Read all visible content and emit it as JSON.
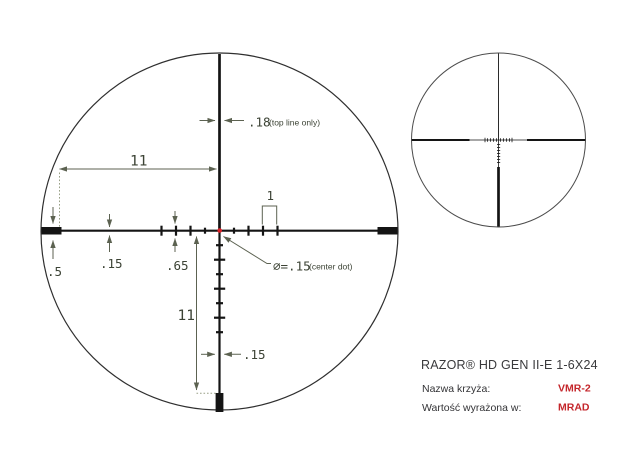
{
  "colors": {
    "ink": "#141414",
    "circle_outline": "#2f2f2f",
    "dimension_lines": "#5c6251",
    "dimension_text": "#3c4335",
    "center_dot_red": "#dd1f26",
    "value_red": "#c4262b",
    "title_text": "#3a3a3c"
  },
  "reticle": {
    "dims": {
      "top_line_width": ".18",
      "top_line_note": "(top line only)",
      "upper_offset": "11",
      "post_height": ".5",
      "line_width": ".15",
      "tick_height": ".65",
      "mil_spacing": "1",
      "center_dot_diameter": "∅=.15",
      "center_dot_note": "(center dot)",
      "lower_offset": "11",
      "lower_line_width": ".15"
    }
  },
  "info": {
    "product_title": "RAZOR® HD GEN II-E 1-6X24",
    "reticle_name_label": "Nazwa krzyża:",
    "reticle_name_value": "VMR-2",
    "unit_label": "Wartość wyrażona w:",
    "unit_value": "MRAD"
  }
}
